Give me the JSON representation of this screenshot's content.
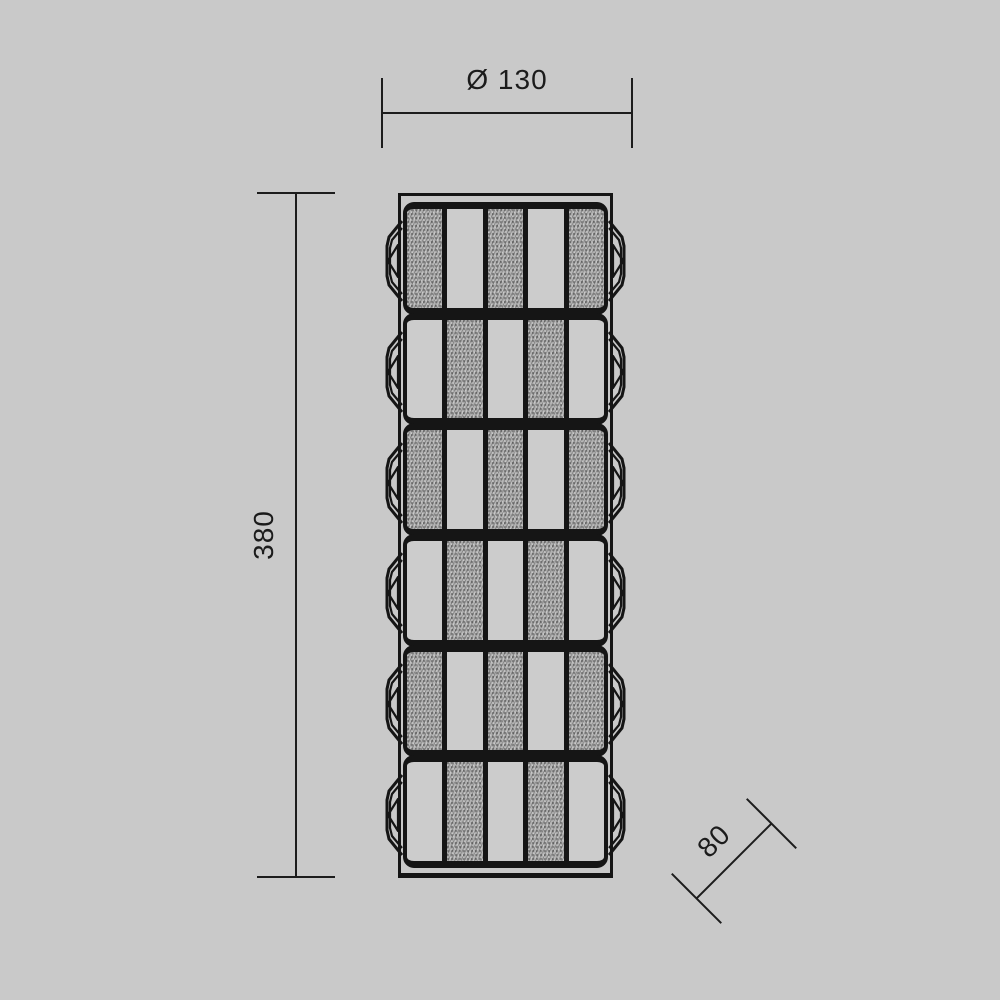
{
  "dimensions": {
    "diameter": {
      "label": "Ø 130",
      "value": 130
    },
    "height": {
      "label": "380",
      "value": 380
    },
    "depth": {
      "label": "80",
      "value": 80
    }
  },
  "fixture": {
    "module_count": 6,
    "bulbs_per_side": 6,
    "modules": [
      {
        "stripes": [
          "hatched",
          "plain",
          "hatched",
          "plain",
          "hatched"
        ]
      },
      {
        "stripes": [
          "plain",
          "hatched",
          "plain",
          "hatched",
          "plain"
        ]
      },
      {
        "stripes": [
          "hatched",
          "plain",
          "hatched",
          "plain",
          "hatched"
        ]
      },
      {
        "stripes": [
          "plain",
          "hatched",
          "plain",
          "hatched",
          "plain"
        ]
      },
      {
        "stripes": [
          "hatched",
          "plain",
          "hatched",
          "plain",
          "hatched"
        ]
      },
      {
        "stripes": [
          "plain",
          "hatched",
          "plain",
          "hatched",
          "plain"
        ]
      }
    ]
  },
  "colors": {
    "background": "#c9c9c9",
    "line": "#1b1b1b",
    "hatch_fill": "#b2b2b2",
    "plain_fill": "#cccccc"
  }
}
